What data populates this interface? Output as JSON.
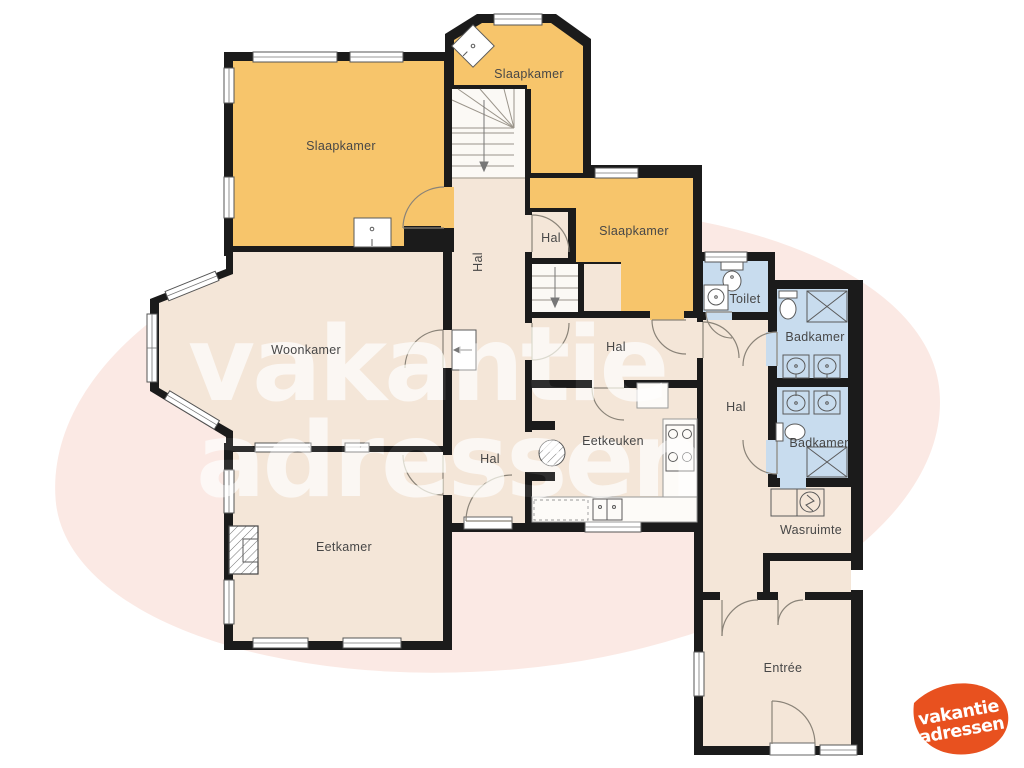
{
  "colors": {
    "wall": "#1b1b1b",
    "bedroom_fill": "#f7c56b",
    "floor_fill": "#f4e6d8",
    "bathroom_fill": "#c8dcee",
    "stair_fill": "#fbf9f5",
    "blob_fill": "#fbe9e4",
    "logo_fill": "#e8511f",
    "label_color": "#474747",
    "watermark_color": "#ffffff"
  },
  "watermark": {
    "line1": "vakantie",
    "line2": "adressen"
  },
  "logo": {
    "line1": "vakantie",
    "line2": "adressen"
  },
  "rooms": [
    {
      "id": "slaapkamer-1",
      "label": "Slaapkamer"
    },
    {
      "id": "slaapkamer-2",
      "label": "Slaapkamer"
    },
    {
      "id": "slaapkamer-3",
      "label": "Slaapkamer"
    },
    {
      "id": "hal-stairs",
      "label": "Hal"
    },
    {
      "id": "hal-landing",
      "label": "Hal"
    },
    {
      "id": "woonkamer",
      "label": "Woonkamer"
    },
    {
      "id": "hal-middle",
      "label": "Hal"
    },
    {
      "id": "toilet",
      "label": "Toilet"
    },
    {
      "id": "badkamer-1",
      "label": "Badkamer"
    },
    {
      "id": "hal-right",
      "label": "Hal"
    },
    {
      "id": "badkamer-2",
      "label": "Badkamer"
    },
    {
      "id": "eetkeuken",
      "label": "Eetkeuken"
    },
    {
      "id": "hal-lower",
      "label": "Hal"
    },
    {
      "id": "eetkamer",
      "label": "Eetkamer"
    },
    {
      "id": "wasruimte",
      "label": "Wasruimte"
    },
    {
      "id": "entree",
      "label": "Entrée"
    }
  ]
}
